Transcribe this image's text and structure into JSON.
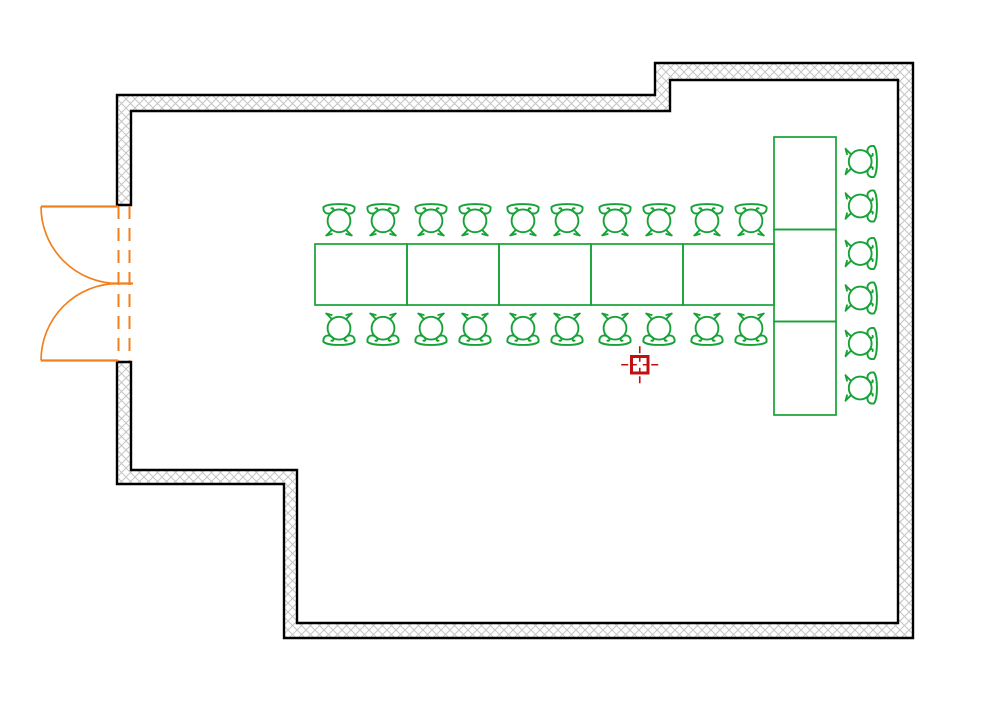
{
  "app": {
    "title": "Banquet room floor plan"
  },
  "canvas": {
    "width": 1000,
    "height": 707,
    "background": "#ffffff"
  },
  "colors": {
    "wall_line": "#000000",
    "wall_hatch": "#c4c4c4",
    "furniture": "#17a237",
    "door": "#f2801e",
    "marker": "#c00f12"
  },
  "plan": {
    "wall": {
      "path": "M117,95 L655,95 L655,63 L913,63 L913,638 L284,638 L284,484 L117,484 L117,362 L131,362 L131,470 L297,470 L297,623 L898,623 L898,80 L670,80 L670,111 L131,111 L131,205 L117,205 Z",
      "stroke_width": 2.4,
      "hatch_cell": 9
    },
    "door": {
      "opening_top": 205,
      "opening_bottom": 362,
      "top_hinge_y": 206.5,
      "bottom_hinge_y": 360.5,
      "meet_y": 283.5,
      "hinge_x": 118,
      "radius": 77,
      "jamb_lines_x": [
        118.5,
        129.5
      ],
      "meet_tick_x": [
        112,
        133
      ]
    },
    "tables": [
      {
        "x": 315,
        "y": 244,
        "w": 92,
        "h": 61
      },
      {
        "x": 407,
        "y": 244,
        "w": 92,
        "h": 61
      },
      {
        "x": 499,
        "y": 244,
        "w": 92,
        "h": 61
      },
      {
        "x": 591,
        "y": 244,
        "w": 92,
        "h": 61
      },
      {
        "x": 683,
        "y": 244,
        "w": 91,
        "h": 61
      },
      {
        "x": 774,
        "y": 137,
        "w": 62,
        "h": 92.5
      },
      {
        "x": 774,
        "y": 229.5,
        "w": 62,
        "h": 92
      },
      {
        "x": 774,
        "y": 321.5,
        "w": 62,
        "h": 93.5
      }
    ],
    "chair_size": {
      "w": 34,
      "h": 37
    },
    "chairs": [
      {
        "x": 322,
        "y": 199,
        "o": "n"
      },
      {
        "x": 366,
        "y": 199,
        "o": "n"
      },
      {
        "x": 414,
        "y": 199,
        "o": "n"
      },
      {
        "x": 458,
        "y": 199,
        "o": "n"
      },
      {
        "x": 506,
        "y": 199,
        "o": "n"
      },
      {
        "x": 550,
        "y": 199,
        "o": "n"
      },
      {
        "x": 598,
        "y": 199,
        "o": "n"
      },
      {
        "x": 642,
        "y": 199,
        "o": "n"
      },
      {
        "x": 690,
        "y": 199,
        "o": "n"
      },
      {
        "x": 734,
        "y": 199,
        "o": "n"
      },
      {
        "x": 322,
        "y": 313,
        "o": "s"
      },
      {
        "x": 366,
        "y": 313,
        "o": "s"
      },
      {
        "x": 414,
        "y": 313,
        "o": "s"
      },
      {
        "x": 458,
        "y": 313,
        "o": "s"
      },
      {
        "x": 506,
        "y": 313,
        "o": "s"
      },
      {
        "x": 550,
        "y": 313,
        "o": "s"
      },
      {
        "x": 598,
        "y": 313,
        "o": "s"
      },
      {
        "x": 642,
        "y": 313,
        "o": "s"
      },
      {
        "x": 690,
        "y": 313,
        "o": "s"
      },
      {
        "x": 734,
        "y": 313,
        "o": "s"
      },
      {
        "x": 845,
        "y": 144.5,
        "o": "e"
      },
      {
        "x": 845,
        "y": 189,
        "o": "e"
      },
      {
        "x": 845,
        "y": 236.5,
        "o": "e"
      },
      {
        "x": 845,
        "y": 281,
        "o": "e"
      },
      {
        "x": 845,
        "y": 326.5,
        "o": "e"
      },
      {
        "x": 845,
        "y": 371,
        "o": "e"
      }
    ],
    "marker": {
      "cx": 639.75,
      "cy": 364.75,
      "size": 16.5,
      "tick_out": 18.5,
      "tick_in": 3
    }
  }
}
